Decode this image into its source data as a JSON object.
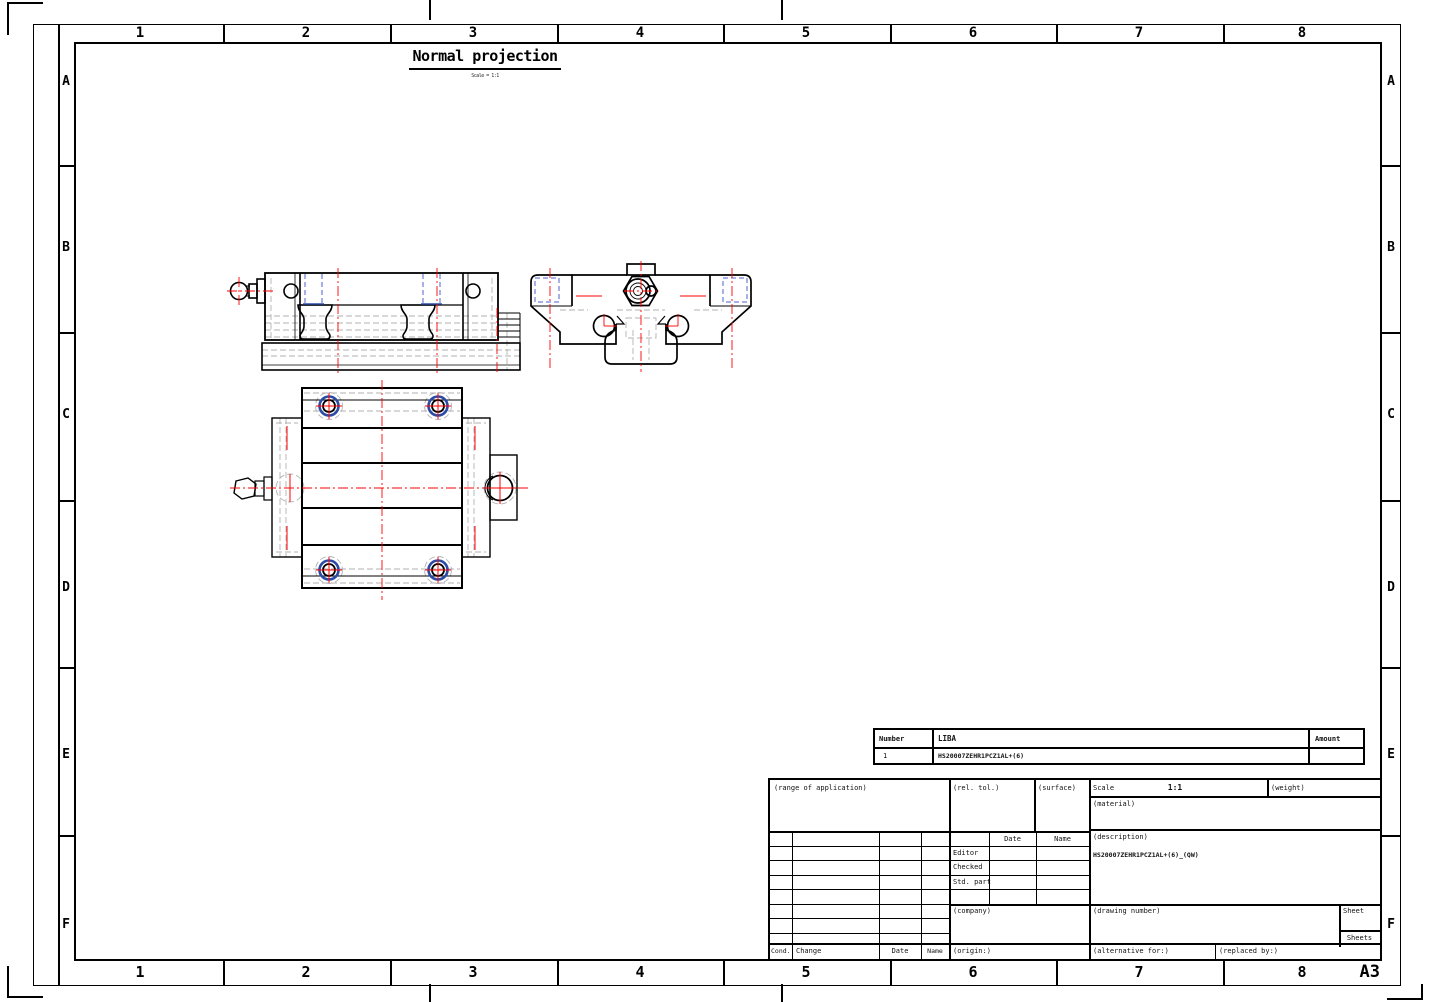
{
  "sheet": {
    "format": "A3",
    "title": "Normal projection",
    "subtitle": "Scale = 1:1",
    "grid": {
      "columns": [
        "1",
        "2",
        "3",
        "4",
        "5",
        "6",
        "7",
        "8"
      ],
      "rows": [
        "A",
        "B",
        "C",
        "D",
        "E",
        "F"
      ]
    },
    "colors": {
      "outline": "#000000",
      "hidden_line": "#b2b2b2",
      "centerline_red": "#ff0000",
      "hole_blue": "#2b4ba6",
      "hole_dash_blue": "#4f63cf"
    }
  },
  "parts_list": {
    "headers": {
      "number": "Number",
      "name": "LIBA",
      "amount": "Amount"
    },
    "rows": [
      {
        "number": "1",
        "name": "HS20007ZEHR1PCZ1AL+(6)",
        "amount": ""
      }
    ]
  },
  "title_block": {
    "range_of_application": "(range of application)",
    "rel_tol": "(rel. tol.)",
    "surface": "(surface)",
    "scale_label": "Scale",
    "scale_value": "1:1",
    "weight": "(weight)",
    "material": "(material)",
    "description_label": "(description)",
    "description_value": "HS20007ZEHR1PCZ1AL+(6)_(QW)",
    "date_header": "Date",
    "name_header": "Name",
    "editor": "Editor",
    "checked": "Checked",
    "std_part": "Std. part",
    "company": "(company)",
    "drawing_number": "(drawing number)",
    "sheet_label": "Sheet",
    "sheets_label": "Sheets",
    "origin": "(origin:)",
    "alternative_for": "(alternative for:)",
    "replaced_by": "(replaced by:)",
    "cond": "Cond.",
    "change": "Change",
    "date": "Date",
    "name": "Name"
  }
}
